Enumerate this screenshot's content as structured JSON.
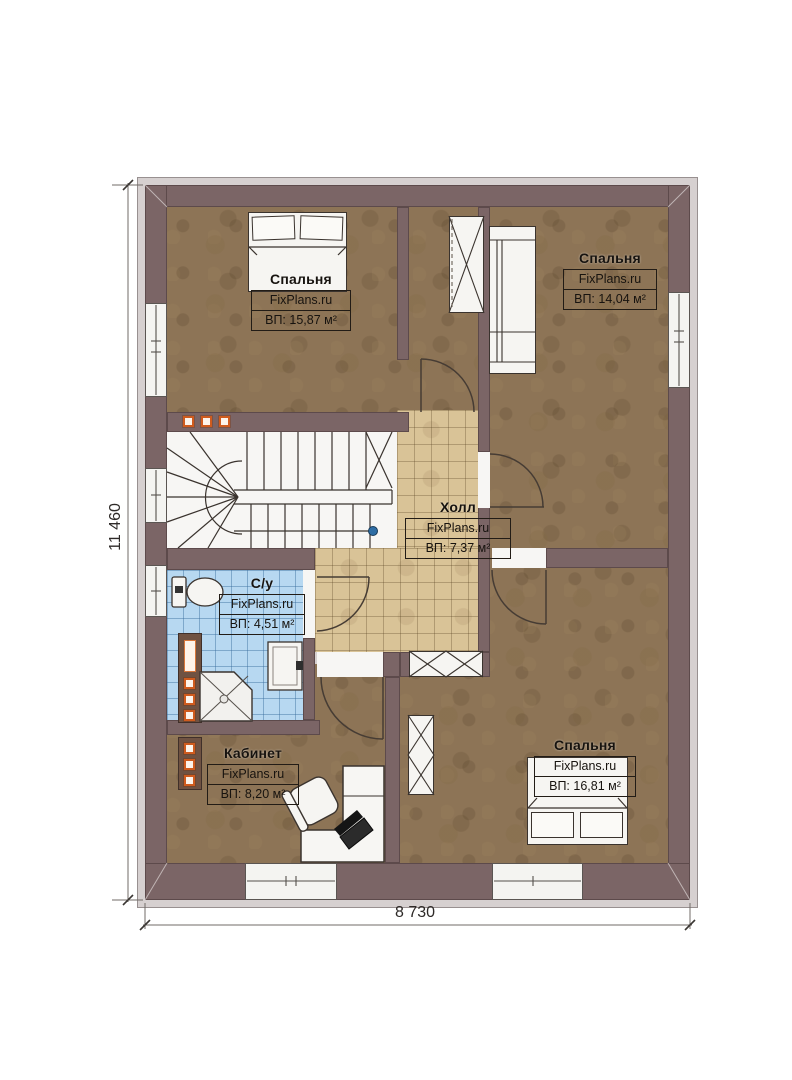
{
  "plan": {
    "watermark": "FixPlans.ru",
    "dimensions": {
      "height_label": "11 460",
      "width_label": "8 730"
    },
    "rooms": [
      {
        "name": "Спальня",
        "watermark": "FixPlans.ru",
        "area": "ВП: 15,87 м²"
      },
      {
        "name": "Спальня",
        "watermark": "FixPlans.ru",
        "area": "ВП: 14,04 м²"
      },
      {
        "name": "Холл",
        "watermark": "FixPlans.ru",
        "area": "ВП: 7,37 м²"
      },
      {
        "name": "С/у",
        "watermark": "FixPlans.ru",
        "area": "ВП: 4,51 м²"
      },
      {
        "name": "Кабинет",
        "watermark": "FixPlans.ru",
        "area": "ВП: 8,20 м²"
      },
      {
        "name": "Спальня",
        "watermark": "FixPlans.ru",
        "area": "ВП: 16,81 м²"
      }
    ],
    "colors": {
      "wall": "#7b6566",
      "floor_wood": "#8d7456",
      "tile_hall": "#d9c397",
      "tile_bath": "#b7d8f1",
      "accent_orange": "#cf5b1e",
      "marker_blue": "#2e6da4"
    }
  }
}
